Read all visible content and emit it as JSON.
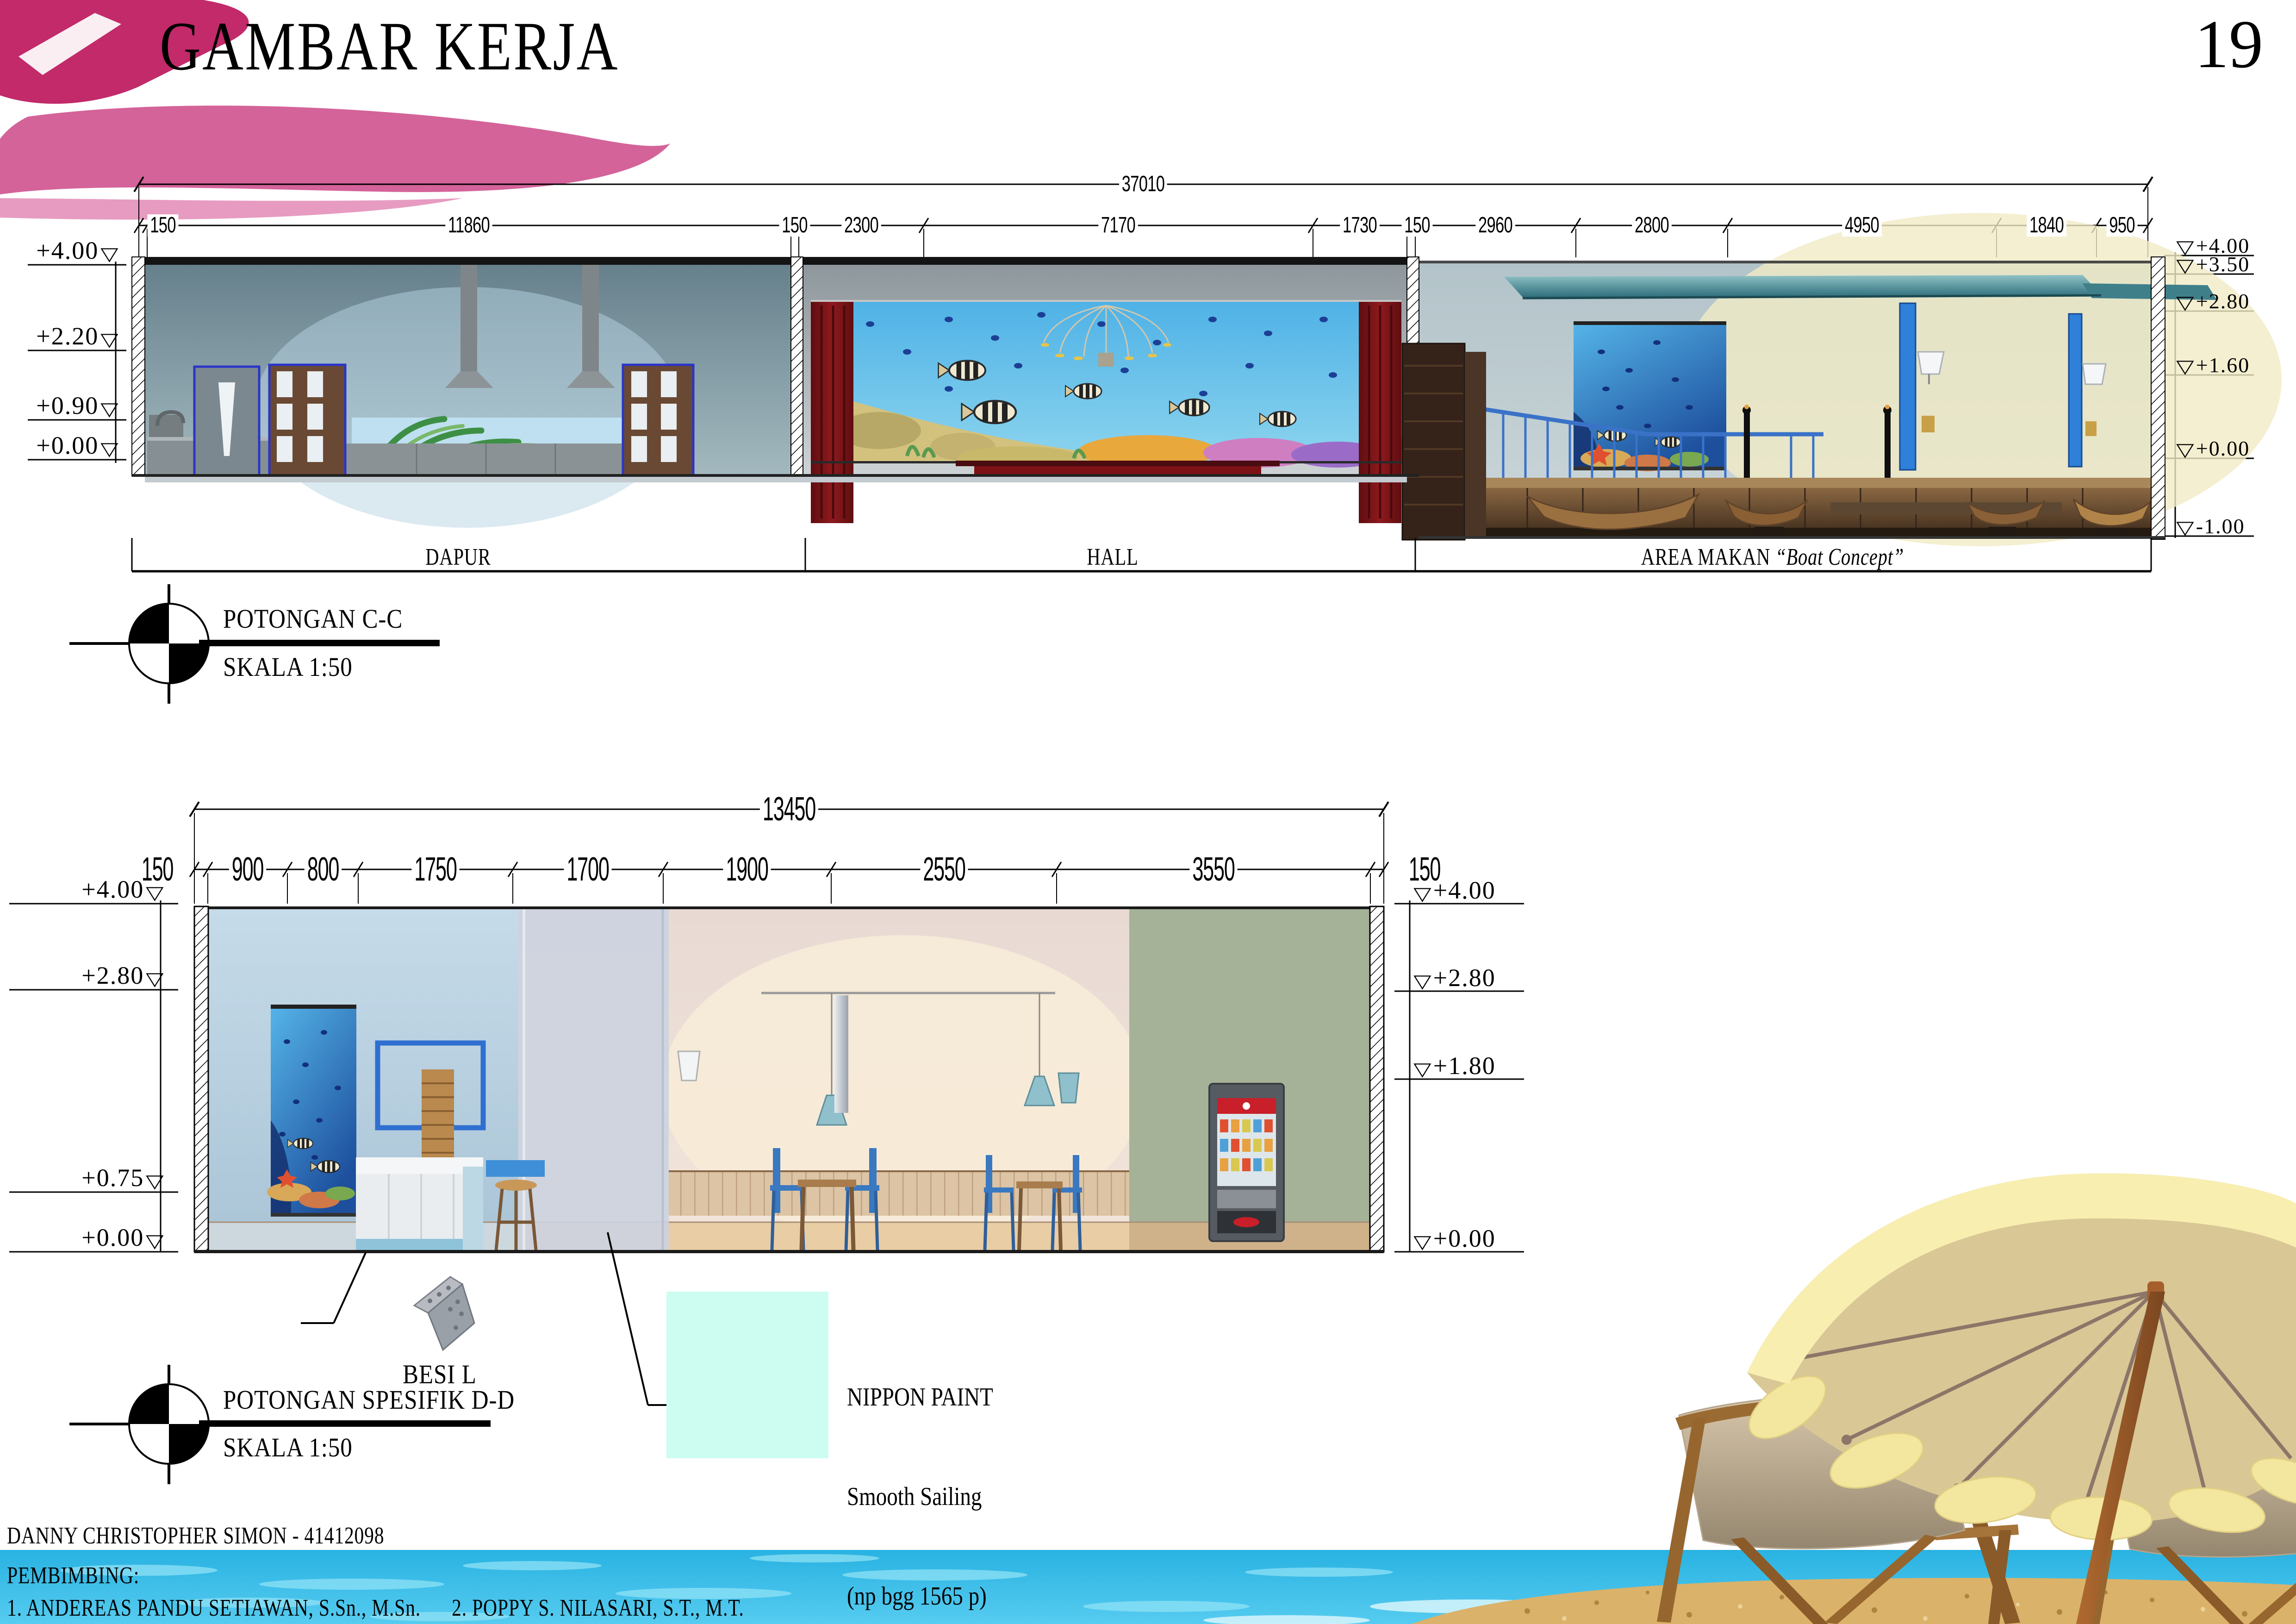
{
  "page": {
    "title": "GAMBAR KERJA",
    "number": "19"
  },
  "icons": {
    "triangle_down": "▽"
  },
  "section_cc": {
    "dims": {
      "total": "37010",
      "segments": [
        "150",
        "11860",
        "150",
        "2300",
        "7170",
        "1730",
        "150",
        "2960",
        "2800",
        "4950",
        "1840",
        "950"
      ]
    },
    "elevations": {
      "left": [
        "+4.00",
        "+2.20",
        "+0.90",
        "+0.00"
      ],
      "right": [
        "+4.00",
        "+3.50",
        "+2.80",
        "+1.60",
        "+0.00",
        "-1.00"
      ]
    },
    "rooms": {
      "dapur": "DAPUR",
      "hall": "HALL",
      "area_makan": "AREA MAKAN ",
      "area_makan_concept": "“Boat Concept”"
    },
    "caption": {
      "title": "POTONGAN C-C",
      "scale": "SKALA 1:50"
    }
  },
  "section_dd": {
    "dims": {
      "total": "13450",
      "segments": [
        "150",
        "900",
        "800",
        "1750",
        "1700",
        "1900",
        "2550",
        "3550",
        "150"
      ]
    },
    "elevations": {
      "left": [
        "+4.00",
        "+2.80",
        "+0.75",
        "+0.00"
      ],
      "right": [
        "+4.00",
        "+2.80",
        "+1.80",
        "+0.00"
      ]
    },
    "caption": {
      "title": "POTONGAN SPESIFIK D-D",
      "scale": "SKALA 1:50"
    },
    "annotations": {
      "besi_l": "BESI L",
      "nippon_1": "NIPPON PAINT",
      "nippon_2": "Smooth Sailing",
      "nippon_3": "(np bgg 1565 p)",
      "swatch_color": "#cdfdf0"
    }
  },
  "footer": {
    "student": "DANNY CHRISTOPHER SIMON - 41412098",
    "pembimbing_label": "PEMBIMBING:",
    "supervisors": "1. ANDEREAS PANDU SETIAWAN, S.Sn., M.Sn.      2. POPPY S. NILASARI, S.T., M.T."
  }
}
